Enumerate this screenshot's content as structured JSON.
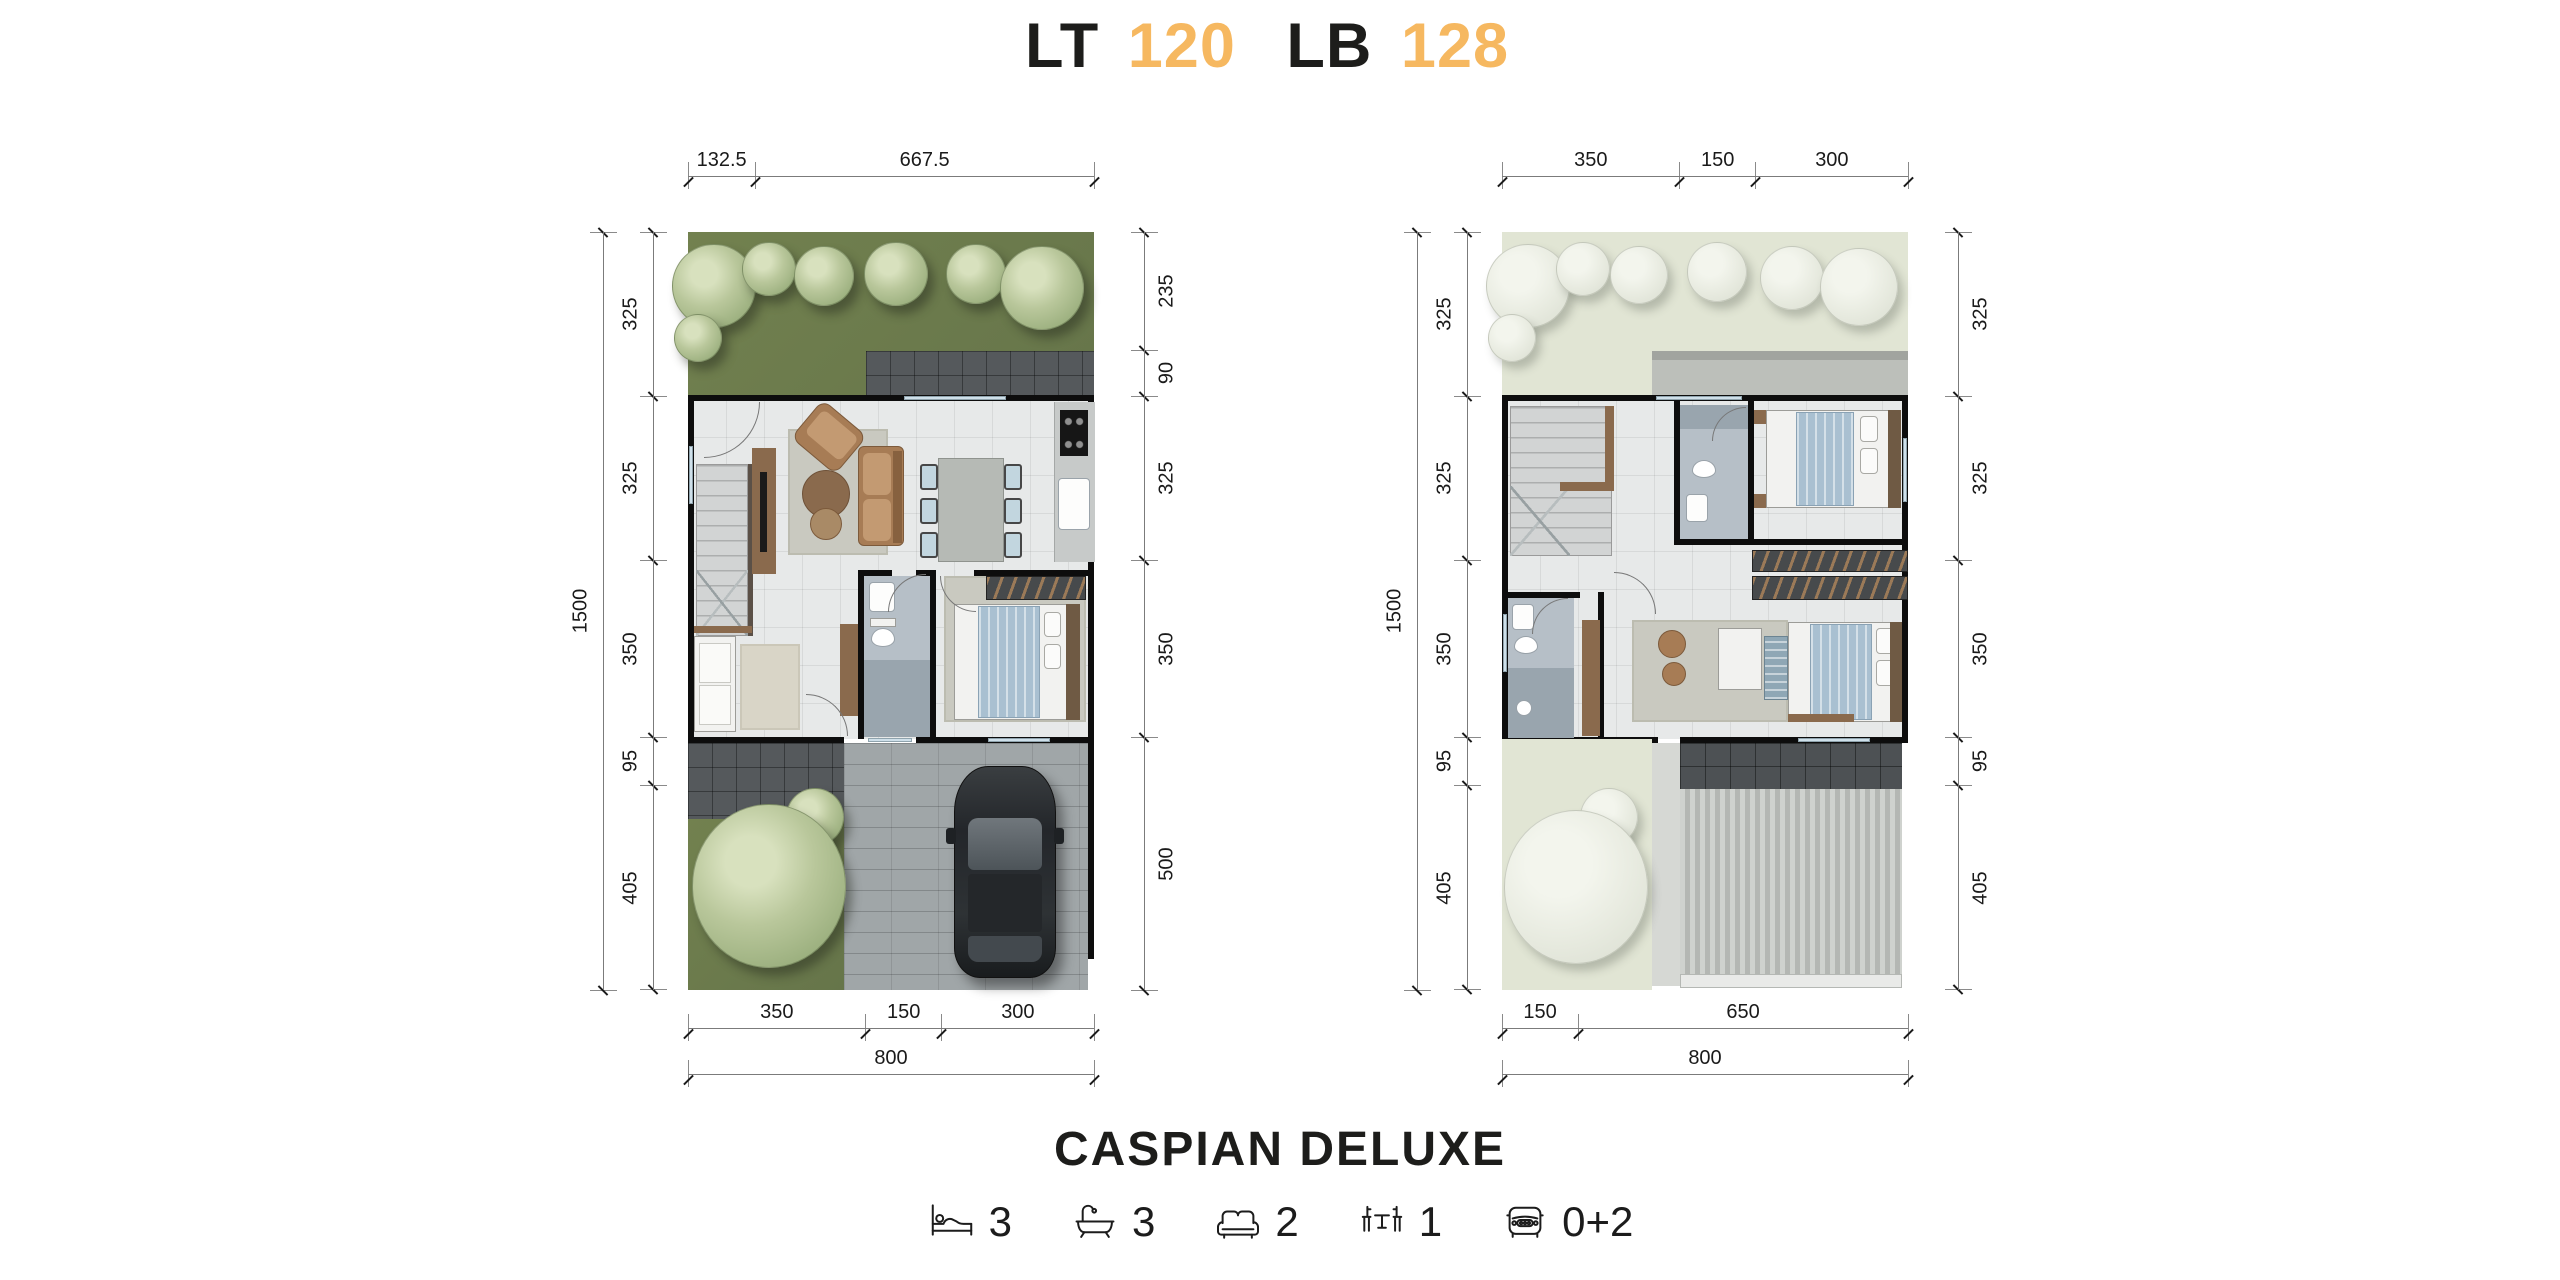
{
  "header": {
    "lt_label": "LT",
    "lt_value": "120",
    "lb_label": "LB",
    "lb_value": "128"
  },
  "footer": {
    "title": "CASPIAN DELUXE"
  },
  "features": [
    {
      "icon": "bed-icon",
      "value": "3"
    },
    {
      "icon": "bath-icon",
      "value": "3"
    },
    {
      "icon": "sofa-icon",
      "value": "2"
    },
    {
      "icon": "dining-icon",
      "value": "1"
    },
    {
      "icon": "car-icon",
      "value": "0+2"
    }
  ],
  "colors": {
    "accent_orange": "#F6B860",
    "wall_black": "#0D0D0D",
    "grass_green": "#70804E",
    "pale_green": "#E2E6D5"
  },
  "floor1": {
    "dims": {
      "top": [
        "132.5",
        "667.5"
      ],
      "left_total": [
        "1500"
      ],
      "left": [
        "325",
        "325",
        "350",
        "95",
        "405"
      ],
      "right": [
        "235",
        "90",
        "325",
        "350",
        "500"
      ],
      "bottom": [
        "350",
        "150",
        "300"
      ],
      "bottom_total": [
        "800"
      ]
    }
  },
  "floor2": {
    "dims": {
      "top": [
        "350",
        "150",
        "300"
      ],
      "left_total": [
        "1500"
      ],
      "left": [
        "325",
        "325",
        "350",
        "95",
        "405"
      ],
      "right": [
        "325",
        "325",
        "350",
        "95",
        "405"
      ],
      "bottom": [
        "150",
        "650"
      ],
      "bottom_total": [
        "800"
      ]
    }
  }
}
